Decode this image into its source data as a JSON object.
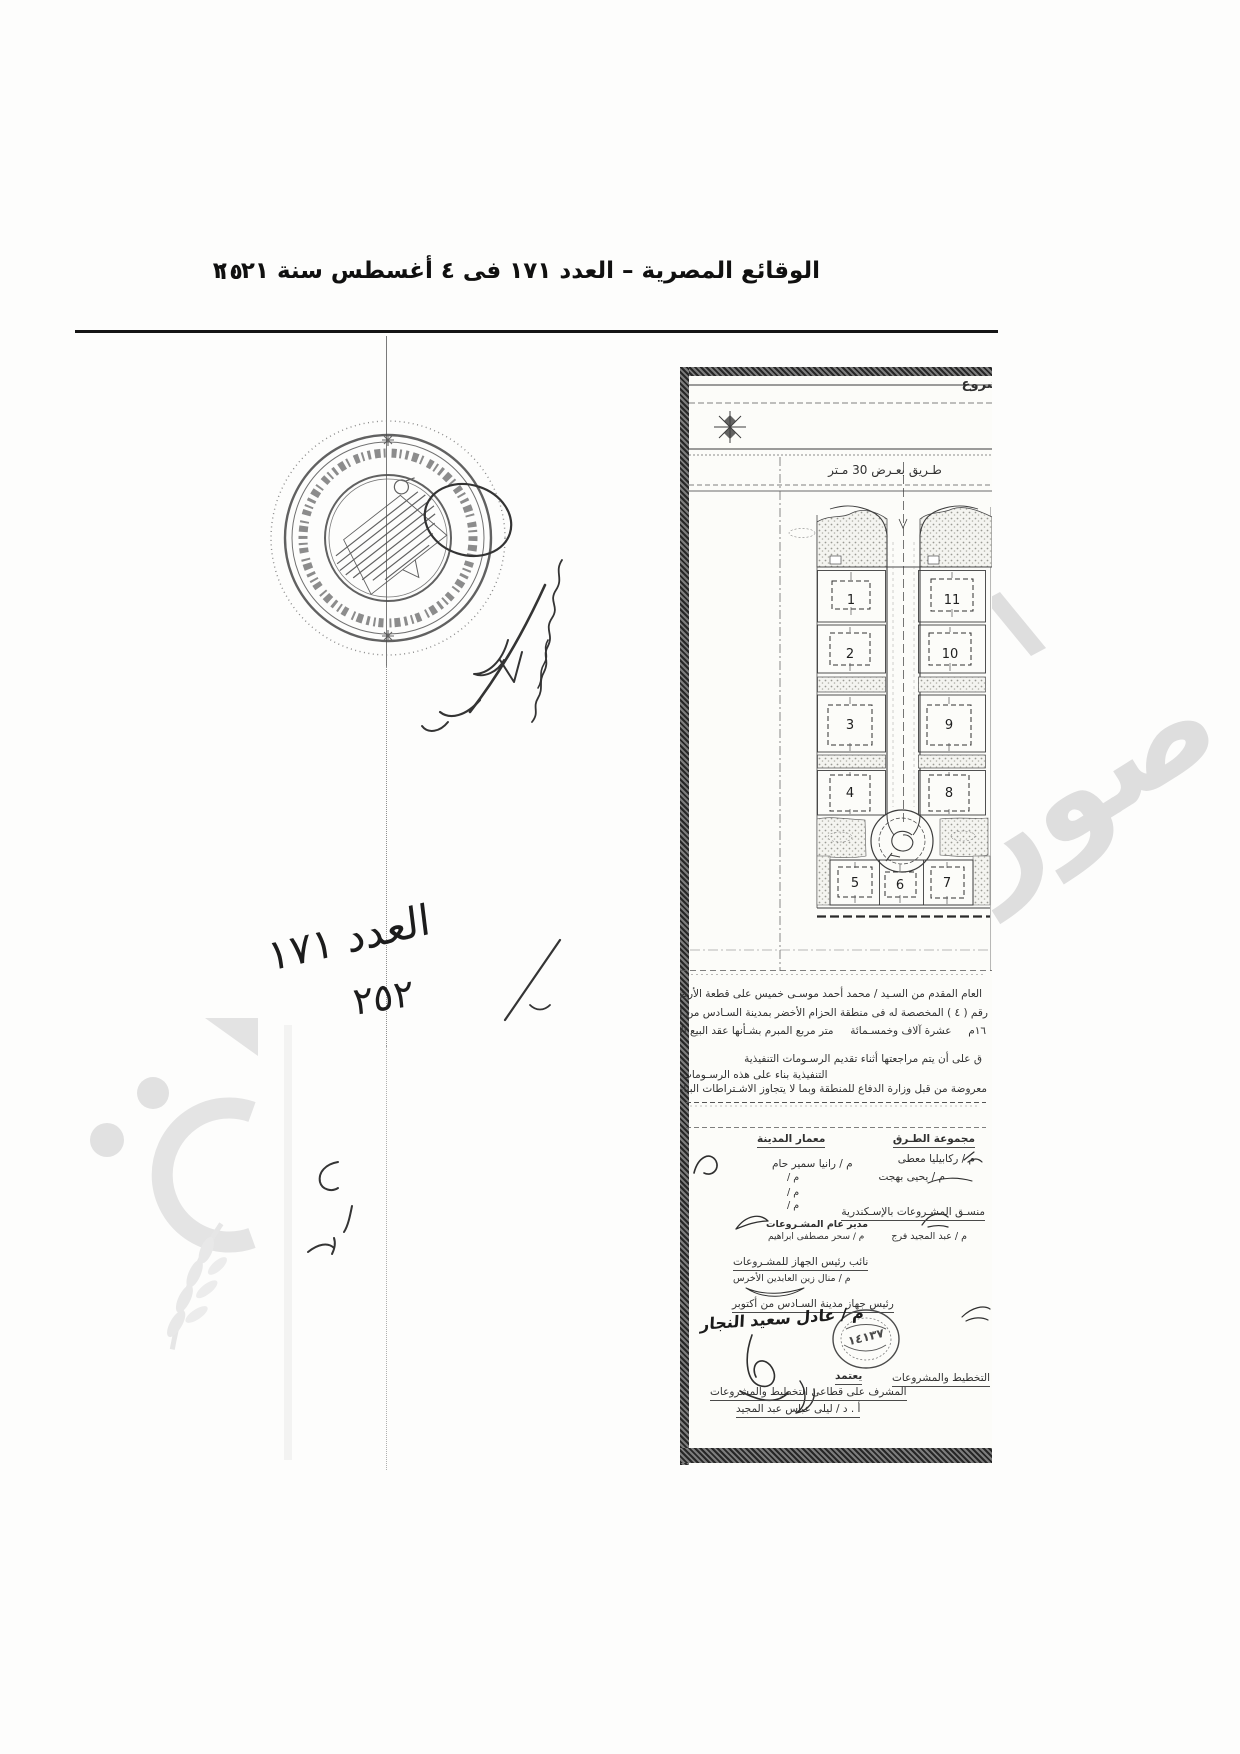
{
  "header": {
    "title": "الوقائع المصرية – العدد ١٧١ فى ٤ أغسطس سنة ٢٠٢١",
    "page_number": "١٥"
  },
  "handwritten": {
    "issue_note": "العدد ١٧١",
    "decree_note": "٢٥٢"
  },
  "stamp": {
    "icon": "egypt-eagle-emblem"
  },
  "watermark": {
    "word": "صورة",
    "color": "#dedede"
  },
  "plan": {
    "title_fragment": "مشروع",
    "north_icon": "compass-star",
    "road_label": "طـريق بعـرض 30 مـتر",
    "plot_numbers": [
      "1",
      "2",
      "3",
      "4",
      "5",
      "6",
      "7",
      "8",
      "9",
      "10",
      "11"
    ],
    "paragraph_lines": [
      "العام المقدم من السـيد / محمد أحمد موسـى خميس على قطعة الأرض رقم",
      "رقم ( ٤ ) المخصصة له فى منطقة الحزام الأخضر بمدينة السـادس من أكتوبر بمسـاحة",
      "١٦م     عشرة آلاف وخمسـمائة     متر مربع المبرم بشـأنها عقد البيع الابتدائى بتاريخ",
      "ق على أن يتم مراجعتها أثناء تقديم الرسـومات التنفيذية",
      "التنفيذية بناء على هذه الرسـومات",
      "معروضة من قبل وزارة الدفاع للمنطقة وبما لا يتجاوز الاشـتراطات البنائية للمشـروع"
    ],
    "signatures": {
      "roads_group": {
        "title": "مجموعة الطـرق",
        "member1": "م / ركابيليا معطى",
        "member2": "م / يحيى بهجت"
      },
      "city_architect": {
        "title": "معمار المدينة",
        "member1": "م / رانيا سمير حام",
        "slot2": "م /",
        "slot3": "م /",
        "slot4": "م /"
      },
      "alex_projects_coordinator": {
        "title": "منسـق المشـروعات بالإسـكندرية",
        "name": "م / عبد المجيد فرج"
      },
      "projects_general_manager": {
        "title": "مدير عام المشـروعات",
        "name": "م / سحر مصطفى ابراهيم"
      },
      "deputy_head": {
        "title": "نائب رئيس الجهاز للمشـروعات",
        "name": "م / منال زين العابدين الأخرس"
      },
      "city_authority_head": {
        "title": "رئيس جهاز مدينة السـادس من أكتوبر",
        "name": "م / عادل سعيد النجار"
      },
      "approval": {
        "word": "يعتمد",
        "title": "المشرف على قطاعى التخطيط والمشروعات",
        "name": "أ . د / ليلى عباس عبد المجيد"
      },
      "planning_fragment": "التخطيط والمشروعات",
      "small_stamp_text": "١٤١٣٧"
    }
  }
}
